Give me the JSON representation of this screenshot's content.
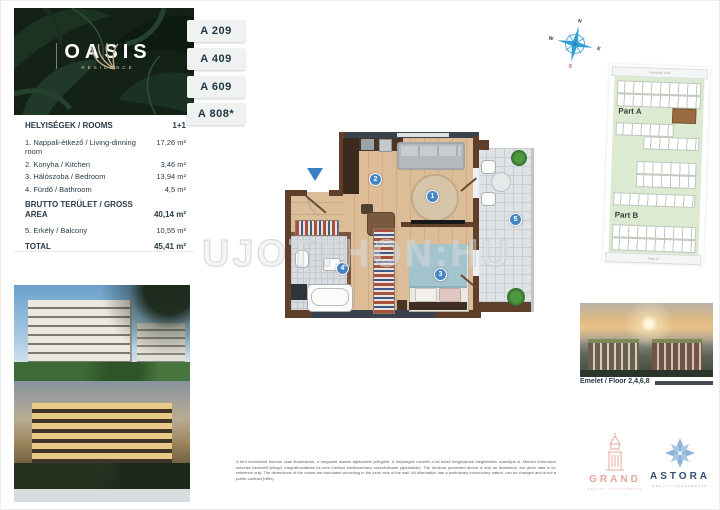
{
  "brand": {
    "name": "OASIS",
    "subtitle": "RESIDENCE"
  },
  "unit_tabs": [
    "A 209",
    "A 409",
    "A 609",
    "A 808*"
  ],
  "rooms": {
    "header": {
      "title": "HELYISÉGEK / ROOMS",
      "layout": "1+1"
    },
    "items": [
      {
        "label": "1. Nappali-étkező / Living-dinning room",
        "area": "17,26 m²"
      },
      {
        "label": "2. Konyha / Kitchen",
        "area": "3,46 m²"
      },
      {
        "label": "3. Hálószoba / Bedroom",
        "area": "13,94 m²"
      },
      {
        "label": "4. Fürdő / Bathroom",
        "area": "4,5 m²"
      }
    ],
    "gross": {
      "label": "BRUTTO TERÜLET / GROSS AREA",
      "area": "40,14 m²"
    },
    "balcony": {
      "label": "5. Erkély / Balcony",
      "area": "10,55 m²"
    },
    "total": {
      "label": "TOTAL",
      "area": "45,41 m²"
    }
  },
  "floor_plan": {
    "room_badges": [
      "1",
      "2",
      "3",
      "4",
      "5"
    ]
  },
  "compass": {
    "north": "N",
    "east": "E",
    "west": "W",
    "south": "S"
  },
  "site_map": {
    "street_top": "Fiastyúk utca",
    "part_a": "Part A",
    "part_b": "Part B",
    "street_bottom": "Tatai út"
  },
  "floor_caption": "Emelet / Floor 2,4,6,8",
  "watermark": "UJOTTHON:HU",
  "disclaimer": "A fent bemutatott bútorok csak illusztrációk, a megadott adatok tájékoztató jellegűek. A helyiségek méretét a fal belső tengelyének megfelelően számítjuk ki. Minden információ előzetes bevezető jellegű, megváltoztatható és nem minősül közbeszerzési szerződésnek (ajánlatnak). The furniture presented above is only an illustration, the given data is for reference only. The dimensions of the rooms are calculated according to the inner axis of the wall. All information has a preliminary introductory nature, can be changed and is not a public contract (offer).",
  "logos": {
    "grand": {
      "name": "GRAND",
      "tagline": "REALTY INVESTMENTS"
    },
    "astora": {
      "name": "ASTORA",
      "tagline": "REALTY INVESTMENTS"
    }
  },
  "colors": {
    "accent_blue": "#4585c6",
    "wall_brown": "#5f3e2a",
    "leaf_green": "#142117",
    "navy_text": "#1d3642",
    "grand_salmon": "#e9a89b",
    "astora_blue": "#8fb4da",
    "south_red": "#c44b3c"
  },
  "icons": {
    "palm-leaf-icon": "palm frond brand mark",
    "compass-icon": "8-point compass rose",
    "entrance-arrow-icon": "▼"
  }
}
